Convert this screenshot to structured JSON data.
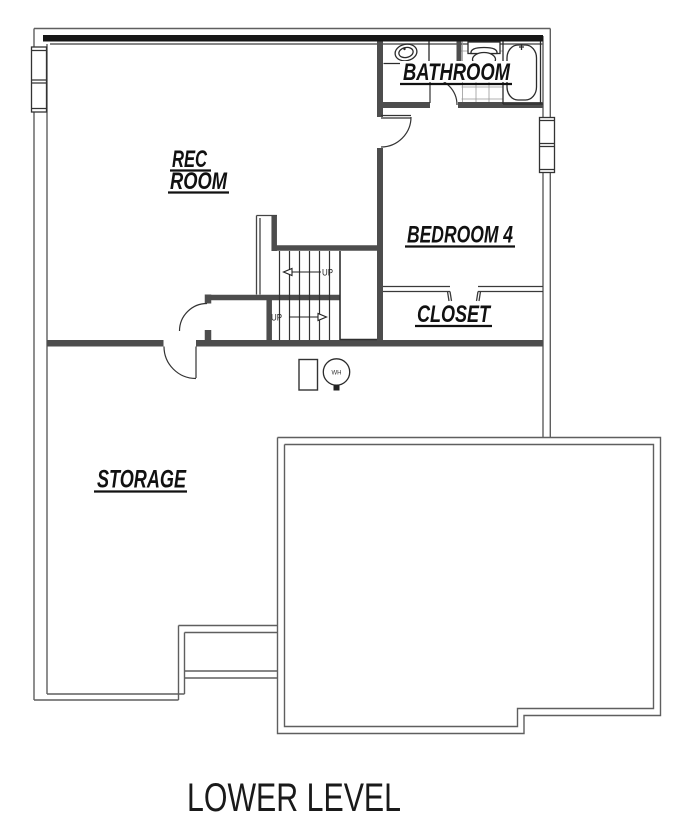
{
  "title": "LOWER LEVEL",
  "labels": {
    "rec_line1": "REC",
    "rec_line2": "ROOM",
    "bathroom": "BATHROOM",
    "bedroom4": "BEDROOM 4",
    "closet": "CLOSET",
    "storage": "STORAGE"
  },
  "stairs": {
    "up_upper": "UP",
    "up_lower": "UP"
  },
  "fixtures": {
    "water_heater_label": "WH"
  },
  "colors": {
    "background": "#ffffff",
    "top_wall": "#161616",
    "exterior_line": "#5f5f5f",
    "interior_wall": "#4d4d4d",
    "fixture_line": "#2b2b2b",
    "tile_line": "#999999",
    "label_text": "#111111"
  }
}
